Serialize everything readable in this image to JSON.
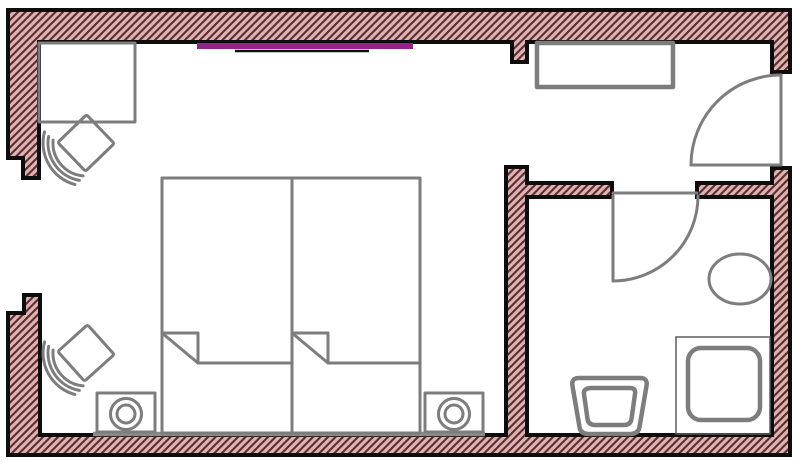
{
  "title": "Hotel guest room floor plan",
  "colors": {
    "background": "#ffffff",
    "wall_fill": "#e0b3b3",
    "hatch_line": "#5d3131",
    "outline_black": "#0d0d0d",
    "furniture_gray": "#7d7d7d",
    "window_accent": "#97218b"
  },
  "plan": {
    "rooms": [
      "bedroom",
      "entry",
      "bathroom"
    ],
    "symbols": [
      "desk",
      "armchair-upper",
      "armchair-lower",
      "twin-bed-left",
      "twin-bed-right",
      "nightstand-lamp-left",
      "nightstand-lamp-right",
      "wardrobe-shelf",
      "window-with-curtain-rod",
      "entry-door-swing",
      "bathroom-door-swing",
      "sink-oval",
      "toilet",
      "shower-tray"
    ],
    "doors": 2,
    "beds": 2,
    "chairs": 2
  }
}
